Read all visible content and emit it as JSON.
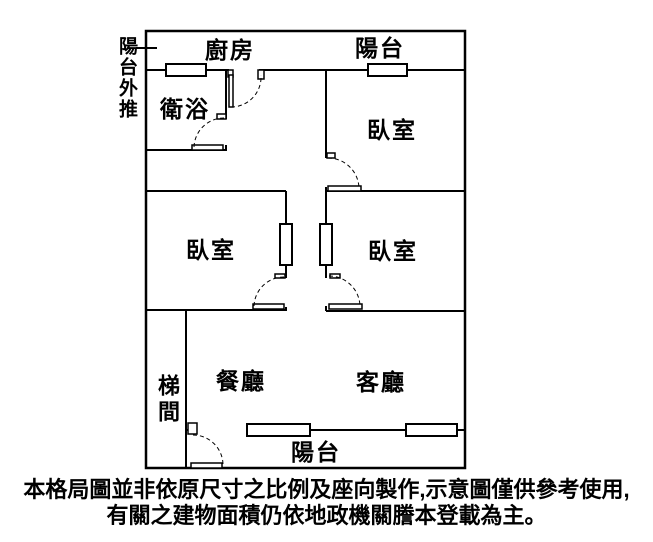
{
  "rooms": {
    "kitchen": "廚房",
    "balcony_top": "陽台",
    "bathroom": "衛浴",
    "bedroom_top_right": "臥室",
    "bedroom_mid_left": "臥室",
    "bedroom_mid_right": "臥室",
    "dining": "餐廳",
    "living": "客廳",
    "stairwell": "梯間",
    "balcony_bottom": "陽台"
  },
  "annotation": {
    "balcony_pushed_out": "陽台外推"
  },
  "caption": {
    "line1": "本格局圖並非依原尺寸之比例及座向製作,示意圖僅供參考使用,",
    "line2": "有關之建物面積仍依地政機關謄本登載為主。"
  },
  "colors": {
    "wall": "#000000",
    "background": "#ffffff",
    "text": "#000000"
  }
}
